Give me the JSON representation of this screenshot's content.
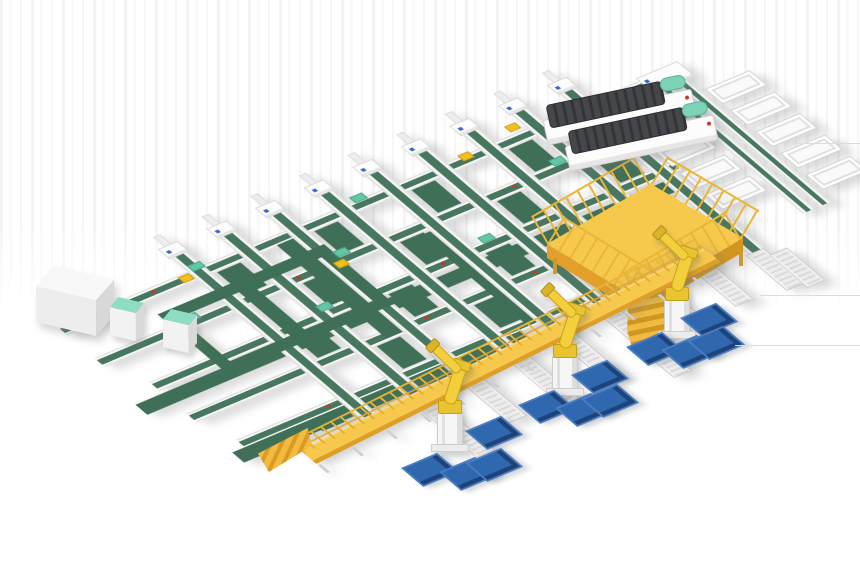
{
  "scene": {
    "description": "Isometric 3D render of an automated solar-module sorting and palletizing production line on a white background",
    "canvas": {
      "width": 860,
      "height": 580
    },
    "background_color": "#ffffff",
    "visible_text": "none"
  },
  "palette": {
    "conveyor_green": "#3f6f56",
    "lane_stripe_green": "#47775f",
    "mint_green": "#63c6a6",
    "walkway_yellow": "#f6c84b",
    "walkway_front_orange": "#e2a02b",
    "railing_yellow": "#eab637",
    "robot_yellow": "#f2cf3b",
    "robot_edge": "#c9a21c",
    "pallet_blue": "#3068b0",
    "pallet_blue_dark": "#1e4379",
    "pallet_blue_light": "#4a7ec2",
    "machine_dark": "#3f4043",
    "marker_red": "#c23b2a",
    "marker_blue": "#2f5fd0",
    "frame_white": "#f8f8f8",
    "frame_gray": "#d8d8d8"
  },
  "components": {
    "sorting_grid": {
      "label": "main conveyor sorting grid",
      "columns": {
        "count": 9,
        "x_start": 104,
        "x_step": 54,
        "y_from": -4,
        "length": 256,
        "lane_width": 18
      },
      "rows": [
        {
          "y": 18,
          "x1": -40,
          "x2": 614
        },
        {
          "y": 68,
          "x1": -40,
          "x2": 614
        },
        {
          "y": 118,
          "x1": -20,
          "x2": 560
        },
        {
          "y": 168,
          "x1": -20,
          "x2": 452
        },
        {
          "y": 218,
          "x1": -6,
          "x2": 452
        }
      ],
      "wide_belts": [
        [
          -50,
          136,
          600,
          16
        ],
        [
          -20,
          230,
          320,
          16
        ],
        [
          194,
          30,
          18,
          148
        ],
        [
          310,
          84,
          18,
          140
        ]
      ],
      "green_patches": [
        [
          126,
          32,
          26,
          36
        ],
        [
          234,
          32,
          26,
          36
        ],
        [
          342,
          32,
          26,
          36
        ],
        [
          450,
          32,
          26,
          36
        ],
        [
          180,
          82,
          26,
          36
        ],
        [
          288,
          82,
          26,
          36
        ],
        [
          396,
          82,
          26,
          36
        ],
        [
          504,
          82,
          26,
          36
        ],
        [
          126,
          132,
          26,
          36
        ],
        [
          234,
          132,
          26,
          36
        ],
        [
          342,
          132,
          26,
          36
        ],
        [
          180,
          182,
          26,
          36
        ],
        [
          288,
          182,
          26,
          36
        ],
        [
          66,
          232,
          26,
          16
        ],
        [
          246,
          232,
          26,
          16
        ]
      ]
    },
    "infeed_loop": {
      "label": "recirculation loop with buffer machines",
      "ring": [
        45,
        50,
        185,
        95
      ],
      "inner_bar": [
        125,
        62,
        16,
        72
      ],
      "machines": [
        {
          "x": 110,
          "y": 297
        },
        {
          "x": 163,
          "y": 309
        }
      ]
    },
    "electrical_cabinet": {
      "label": "gray cabinet at line infeed",
      "x": 36,
      "y": 266
    },
    "trunk_line": {
      "label": "takeaway trunk conveyor with fishbone chutes",
      "lanes": [
        [
          612,
          36,
          14,
          196
        ],
        [
          630,
          36,
          14,
          196
        ]
      ],
      "head_cap": [
        606,
        14,
        46,
        24
      ],
      "connector": [
        532,
        36,
        84,
        13
      ],
      "chutes_left": [
        [
          556,
          100
        ],
        [
          556,
          134
        ],
        [
          556,
          168
        ]
      ],
      "chutes_right": [
        [
          648,
          56
        ],
        [
          648,
          90
        ],
        [
          648,
          124
        ],
        [
          648,
          158
        ],
        [
          648,
          192
        ]
      ],
      "chute_size": [
        50,
        24
      ]
    },
    "laminator_machines": {
      "label": "dark process machines on cross lanes",
      "count": 2,
      "positions": [
        {
          "x": 544,
          "y": 102,
          "rot": -12
        },
        {
          "x": 566,
          "y": 128,
          "rot": -12
        }
      ]
    },
    "service_platform": {
      "label": "yellow fenced maintenance platform with stairs",
      "x": 543,
      "y": 178
    },
    "walkway": {
      "label": "elevated yellow inspection walkway with railings and end ramp",
      "origin": [
        300,
        450
      ],
      "length": 452
    },
    "roller_conveyors": [
      [
        158,
        252,
        344
      ],
      [
        212,
        252,
        322
      ],
      [
        266,
        252,
        346
      ],
      [
        320,
        252,
        322
      ],
      [
        374,
        252,
        348
      ],
      [
        428,
        252,
        318
      ],
      [
        482,
        252,
        300
      ],
      [
        534,
        252,
        306
      ],
      [
        552,
        262,
        312
      ]
    ],
    "robots": {
      "label": "yellow palletizing robot arms on pedestals",
      "count": 3,
      "positions": [
        {
          "x": 450,
          "y": 452
        },
        {
          "x": 565,
          "y": 396
        },
        {
          "x": 677,
          "y": 339
        }
      ]
    },
    "pallets": {
      "label": "blue module pallets on floor stands",
      "count": 12,
      "positions": [
        [
          465,
          431
        ],
        [
          401,
          468
        ],
        [
          439,
          472
        ],
        [
          465,
          463
        ],
        [
          571,
          375
        ],
        [
          518,
          405
        ],
        [
          555,
          408
        ],
        [
          581,
          399
        ],
        [
          680,
          318
        ],
        [
          626,
          347
        ],
        [
          661,
          350
        ],
        [
          687,
          341
        ]
      ]
    },
    "mint_caps": [
      [
        109,
        12
      ],
      [
        229,
        62
      ],
      [
        349,
        112
      ],
      [
        169,
        112
      ],
      [
        289,
        12
      ],
      [
        469,
        62
      ],
      [
        61,
        64
      ],
      [
        409,
        162
      ]
    ],
    "red_markers": [
      [
        60,
        22
      ],
      [
        180,
        72
      ],
      [
        300,
        122
      ],
      [
        420,
        72
      ],
      [
        240,
        172
      ],
      [
        90,
        222
      ],
      [
        510,
        22
      ],
      [
        360,
        172
      ]
    ],
    "blue_markers": [
      [
        165,
        243
      ],
      [
        219,
        243
      ],
      [
        273,
        243
      ],
      [
        327,
        243
      ],
      [
        381,
        243
      ],
      [
        435,
        243
      ]
    ],
    "yellow_devices": [
      [
        466,
        6
      ],
      [
        406,
        16
      ],
      [
        220,
        74
      ],
      [
        92,
        20
      ]
    ],
    "artifacts": {
      "h_lines": [
        [
          760,
          295,
          860
        ],
        [
          735,
          345,
          860
        ],
        [
          797,
          143,
          860
        ]
      ]
    }
  }
}
